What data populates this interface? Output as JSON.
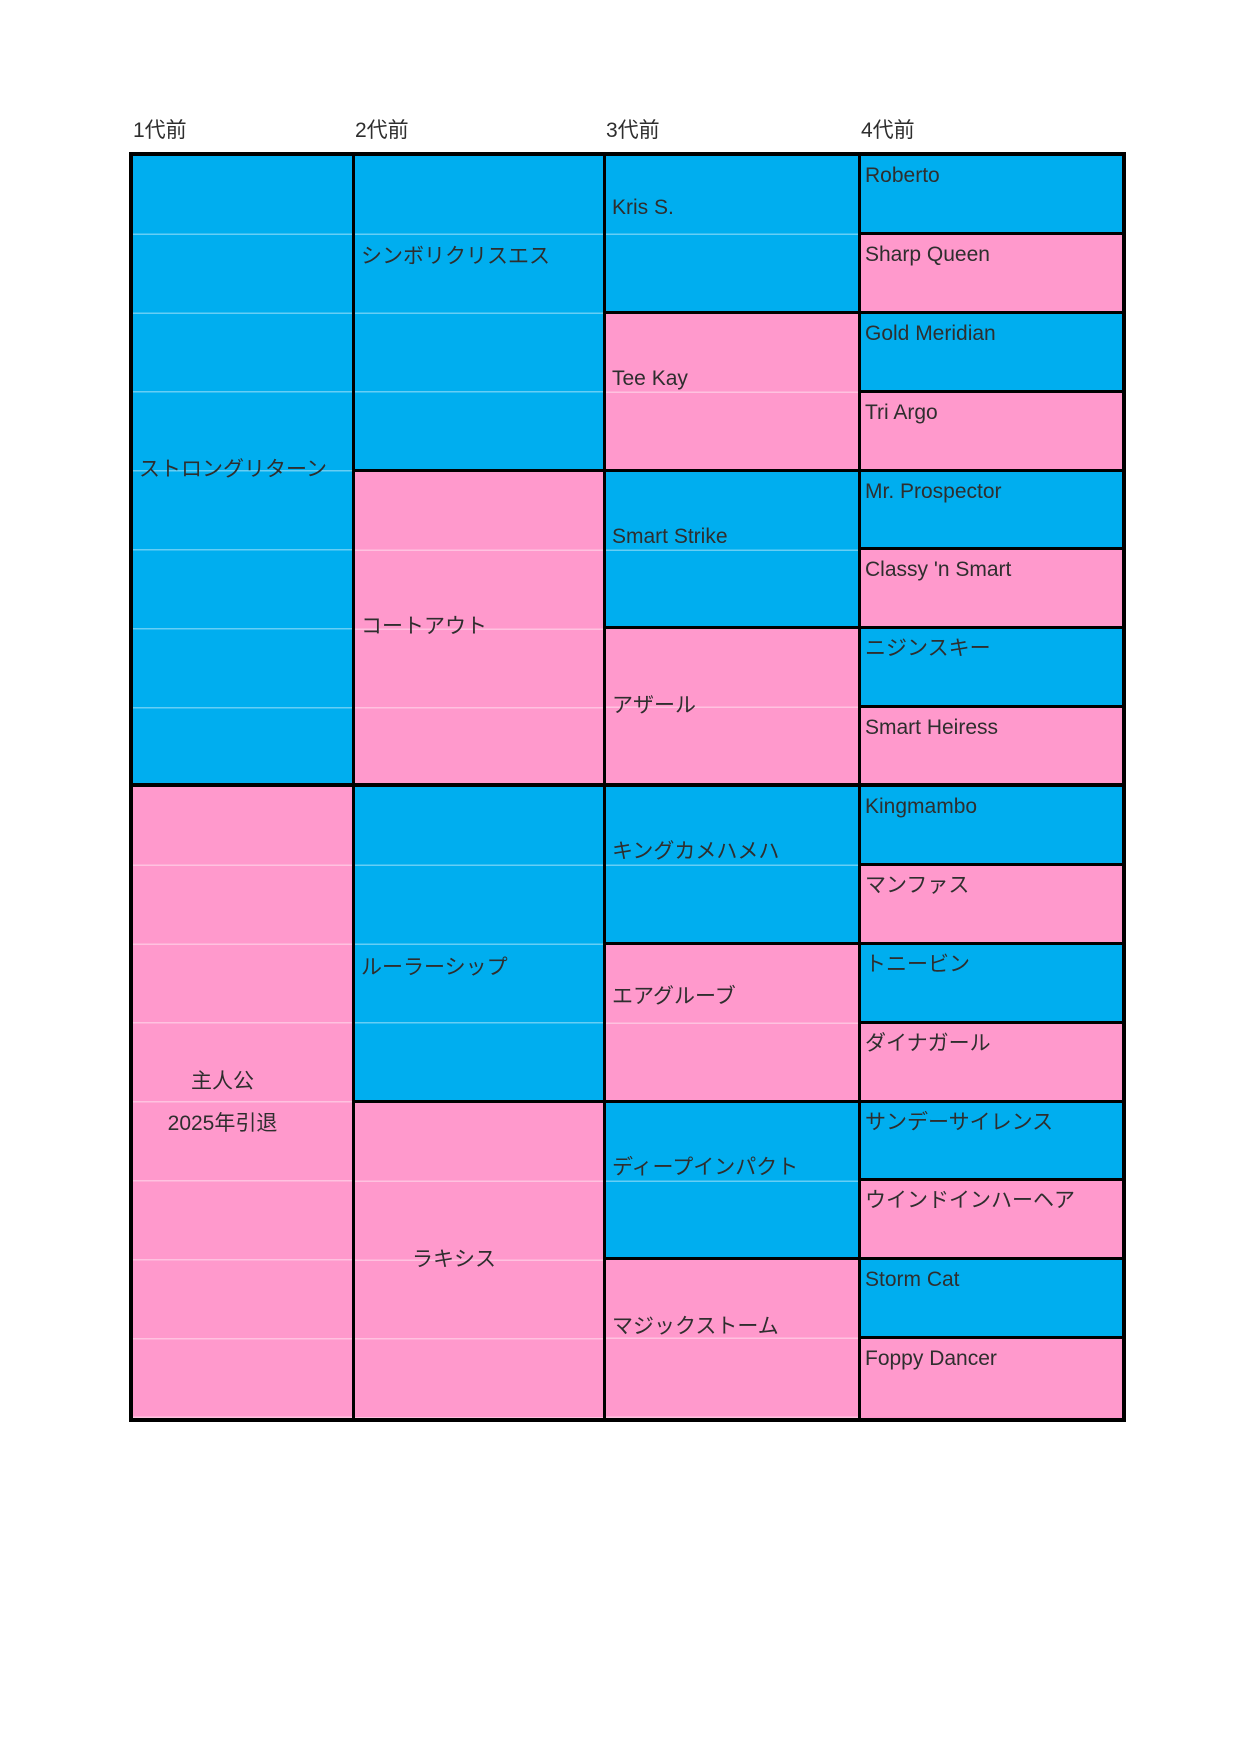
{
  "colors": {
    "male_cell": "#00AEEF",
    "female_cell": "#FF99CC",
    "border": "#000000",
    "text": "#2E2E2E",
    "page_background": "#FFFFFF"
  },
  "generation_headers": [
    "1代前",
    "2代前",
    "3代前",
    "4代前"
  ],
  "pedigree": {
    "gen1": [
      {
        "name": "ストロングリターン",
        "sex": "male"
      },
      {
        "name": "主人公",
        "note": "2025年引退",
        "sex": "female"
      }
    ],
    "gen2": [
      {
        "name": "シンボリクリスエス",
        "sex": "male"
      },
      {
        "name": "コートアウト",
        "sex": "female"
      },
      {
        "name": "ルーラーシップ",
        "sex": "male"
      },
      {
        "name": "ラキシス",
        "sex": "female"
      }
    ],
    "gen3": [
      {
        "name": "Kris S.",
        "sex": "male"
      },
      {
        "name": "Tee Kay",
        "sex": "female"
      },
      {
        "name": "Smart Strike",
        "sex": "male"
      },
      {
        "name": "アザール",
        "sex": "female"
      },
      {
        "name": "キングカメハメハ",
        "sex": "male"
      },
      {
        "name": "エアグルーブ",
        "sex": "female"
      },
      {
        "name": "ディープインパクト",
        "sex": "male"
      },
      {
        "name": "マジックストーム",
        "sex": "female"
      }
    ],
    "gen4": [
      {
        "name": "Roberto",
        "sex": "male"
      },
      {
        "name": "Sharp Queen",
        "sex": "female"
      },
      {
        "name": "Gold Meridian",
        "sex": "male"
      },
      {
        "name": "Tri Argo",
        "sex": "female"
      },
      {
        "name": "Mr. Prospector",
        "sex": "male"
      },
      {
        "name": "Classy 'n Smart",
        "sex": "female"
      },
      {
        "name": "ニジンスキー",
        "sex": "male"
      },
      {
        "name": "Smart Heiress",
        "sex": "female"
      },
      {
        "name": "Kingmambo",
        "sex": "male"
      },
      {
        "name": "マンファス",
        "sex": "female"
      },
      {
        "name": "トニービン",
        "sex": "male"
      },
      {
        "name": "ダイナガール",
        "sex": "female"
      },
      {
        "name": "サンデーサイレンス",
        "sex": "male"
      },
      {
        "name": "ウインドインハーヘア",
        "sex": "female"
      },
      {
        "name": "Storm Cat",
        "sex": "male"
      },
      {
        "name": "Foppy Dancer",
        "sex": "female"
      }
    ]
  }
}
